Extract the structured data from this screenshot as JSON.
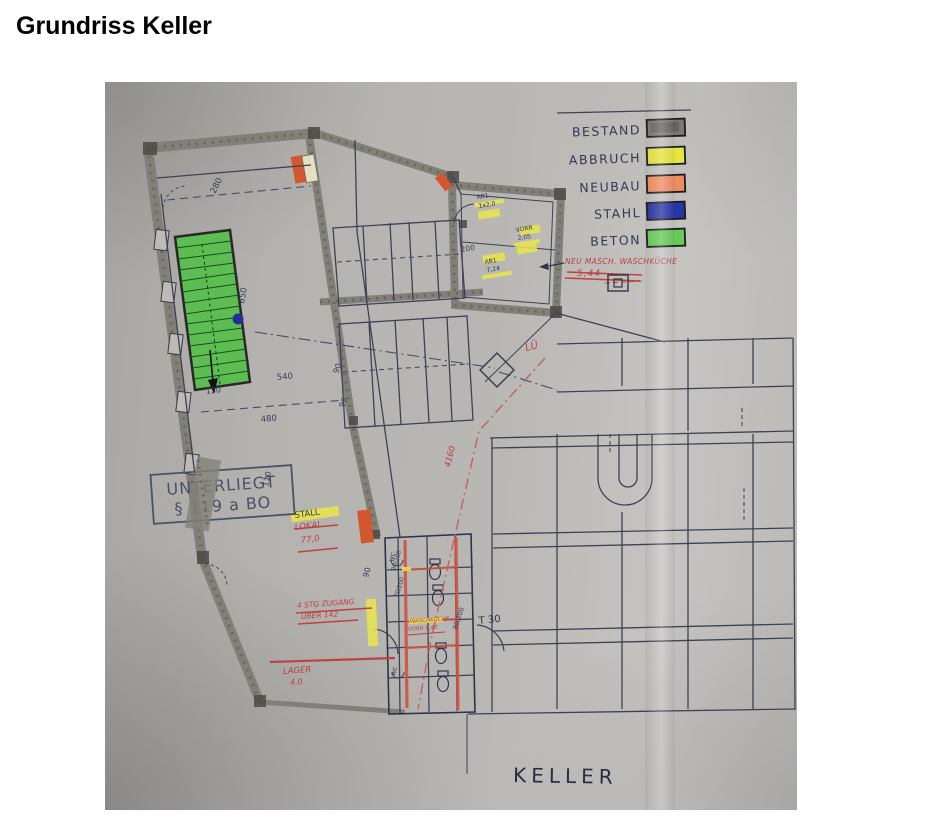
{
  "page": {
    "title": "Grundriss Keller"
  },
  "photo": {
    "legend": {
      "items": [
        {
          "id": "bestand",
          "label": "BESTAND",
          "color": "#7a7875"
        },
        {
          "id": "abbruch",
          "label": "ABBRUCH",
          "color": "#e6e440"
        },
        {
          "id": "neubau",
          "label": "NEUBAU",
          "color": "#ef8d62"
        },
        {
          "id": "stahl",
          "label": "STAHL",
          "color": "#2a35a5"
        },
        {
          "id": "beton",
          "label": "BETON",
          "color": "#68ca57"
        }
      ]
    },
    "stamp": {
      "line1": "UNTERLIEGT",
      "line2": "§ 119 a BO"
    },
    "labels": {
      "room": "KELLER"
    },
    "annotations": {
      "neu_masch": "NEU MASCH. WASCHKÜCHE",
      "area_544": "5,44",
      "lue": "LÜ",
      "dim_4160": "4160",
      "stall": "STALL",
      "lokal": "LOKAL",
      "area_770": "77,0",
      "zugang_line1": "4 STG ZUGANG",
      "zugang_line2": "ÜBER 142",
      "lager": "LAGER",
      "area_40": "4,0",
      "waschkueche": "WASCHKÜCHE",
      "vorr_940": "VORR 9,40",
      "t30": "T 30",
      "wc": "WC",
      "ab1_a": "AB1",
      "ab1_a2": "1x2,0",
      "vorr": "VORR",
      "vorr2": "2,05",
      "ab1_b": "AB1",
      "ab1_b2": "7,24"
    },
    "dimensions": {
      "d280": "280",
      "d650": "650",
      "d540": "540",
      "d130": "130",
      "d480": "480",
      "d90": "90",
      "d110": "110",
      "d200": "200",
      "d80200": "80/200",
      "d90200": "90/200",
      "d70200": "70/200"
    }
  }
}
